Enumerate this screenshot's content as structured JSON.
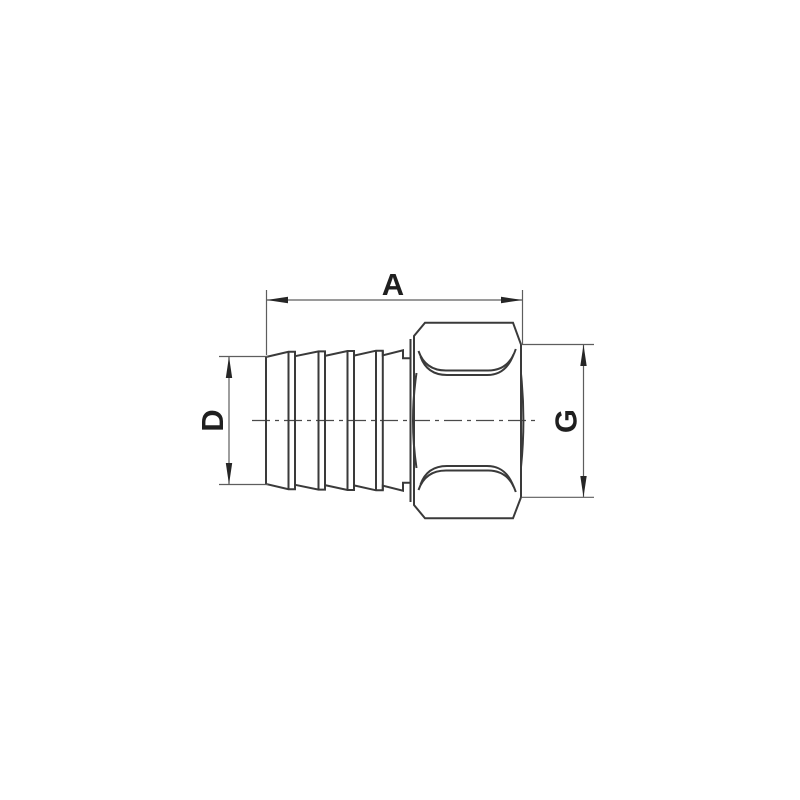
{
  "drawing": {
    "kind": "technical-dimension-drawing",
    "subject": "hose-barb-to-female-thread-fitting-side-view",
    "background_color": "#ffffff",
    "object_line_color": "#3a3a3a",
    "dimension_line_color": "#5d5d5d",
    "label_color": "#1f1f1f",
    "barb_ridge_count": 4,
    "dimensions": [
      {
        "id": "A",
        "label": "A",
        "orientation": "horizontal",
        "position": "top"
      },
      {
        "id": "D",
        "label": "D",
        "orientation": "vertical",
        "position": "left"
      },
      {
        "id": "G",
        "label": "G",
        "orientation": "vertical",
        "position": "right"
      }
    ]
  }
}
